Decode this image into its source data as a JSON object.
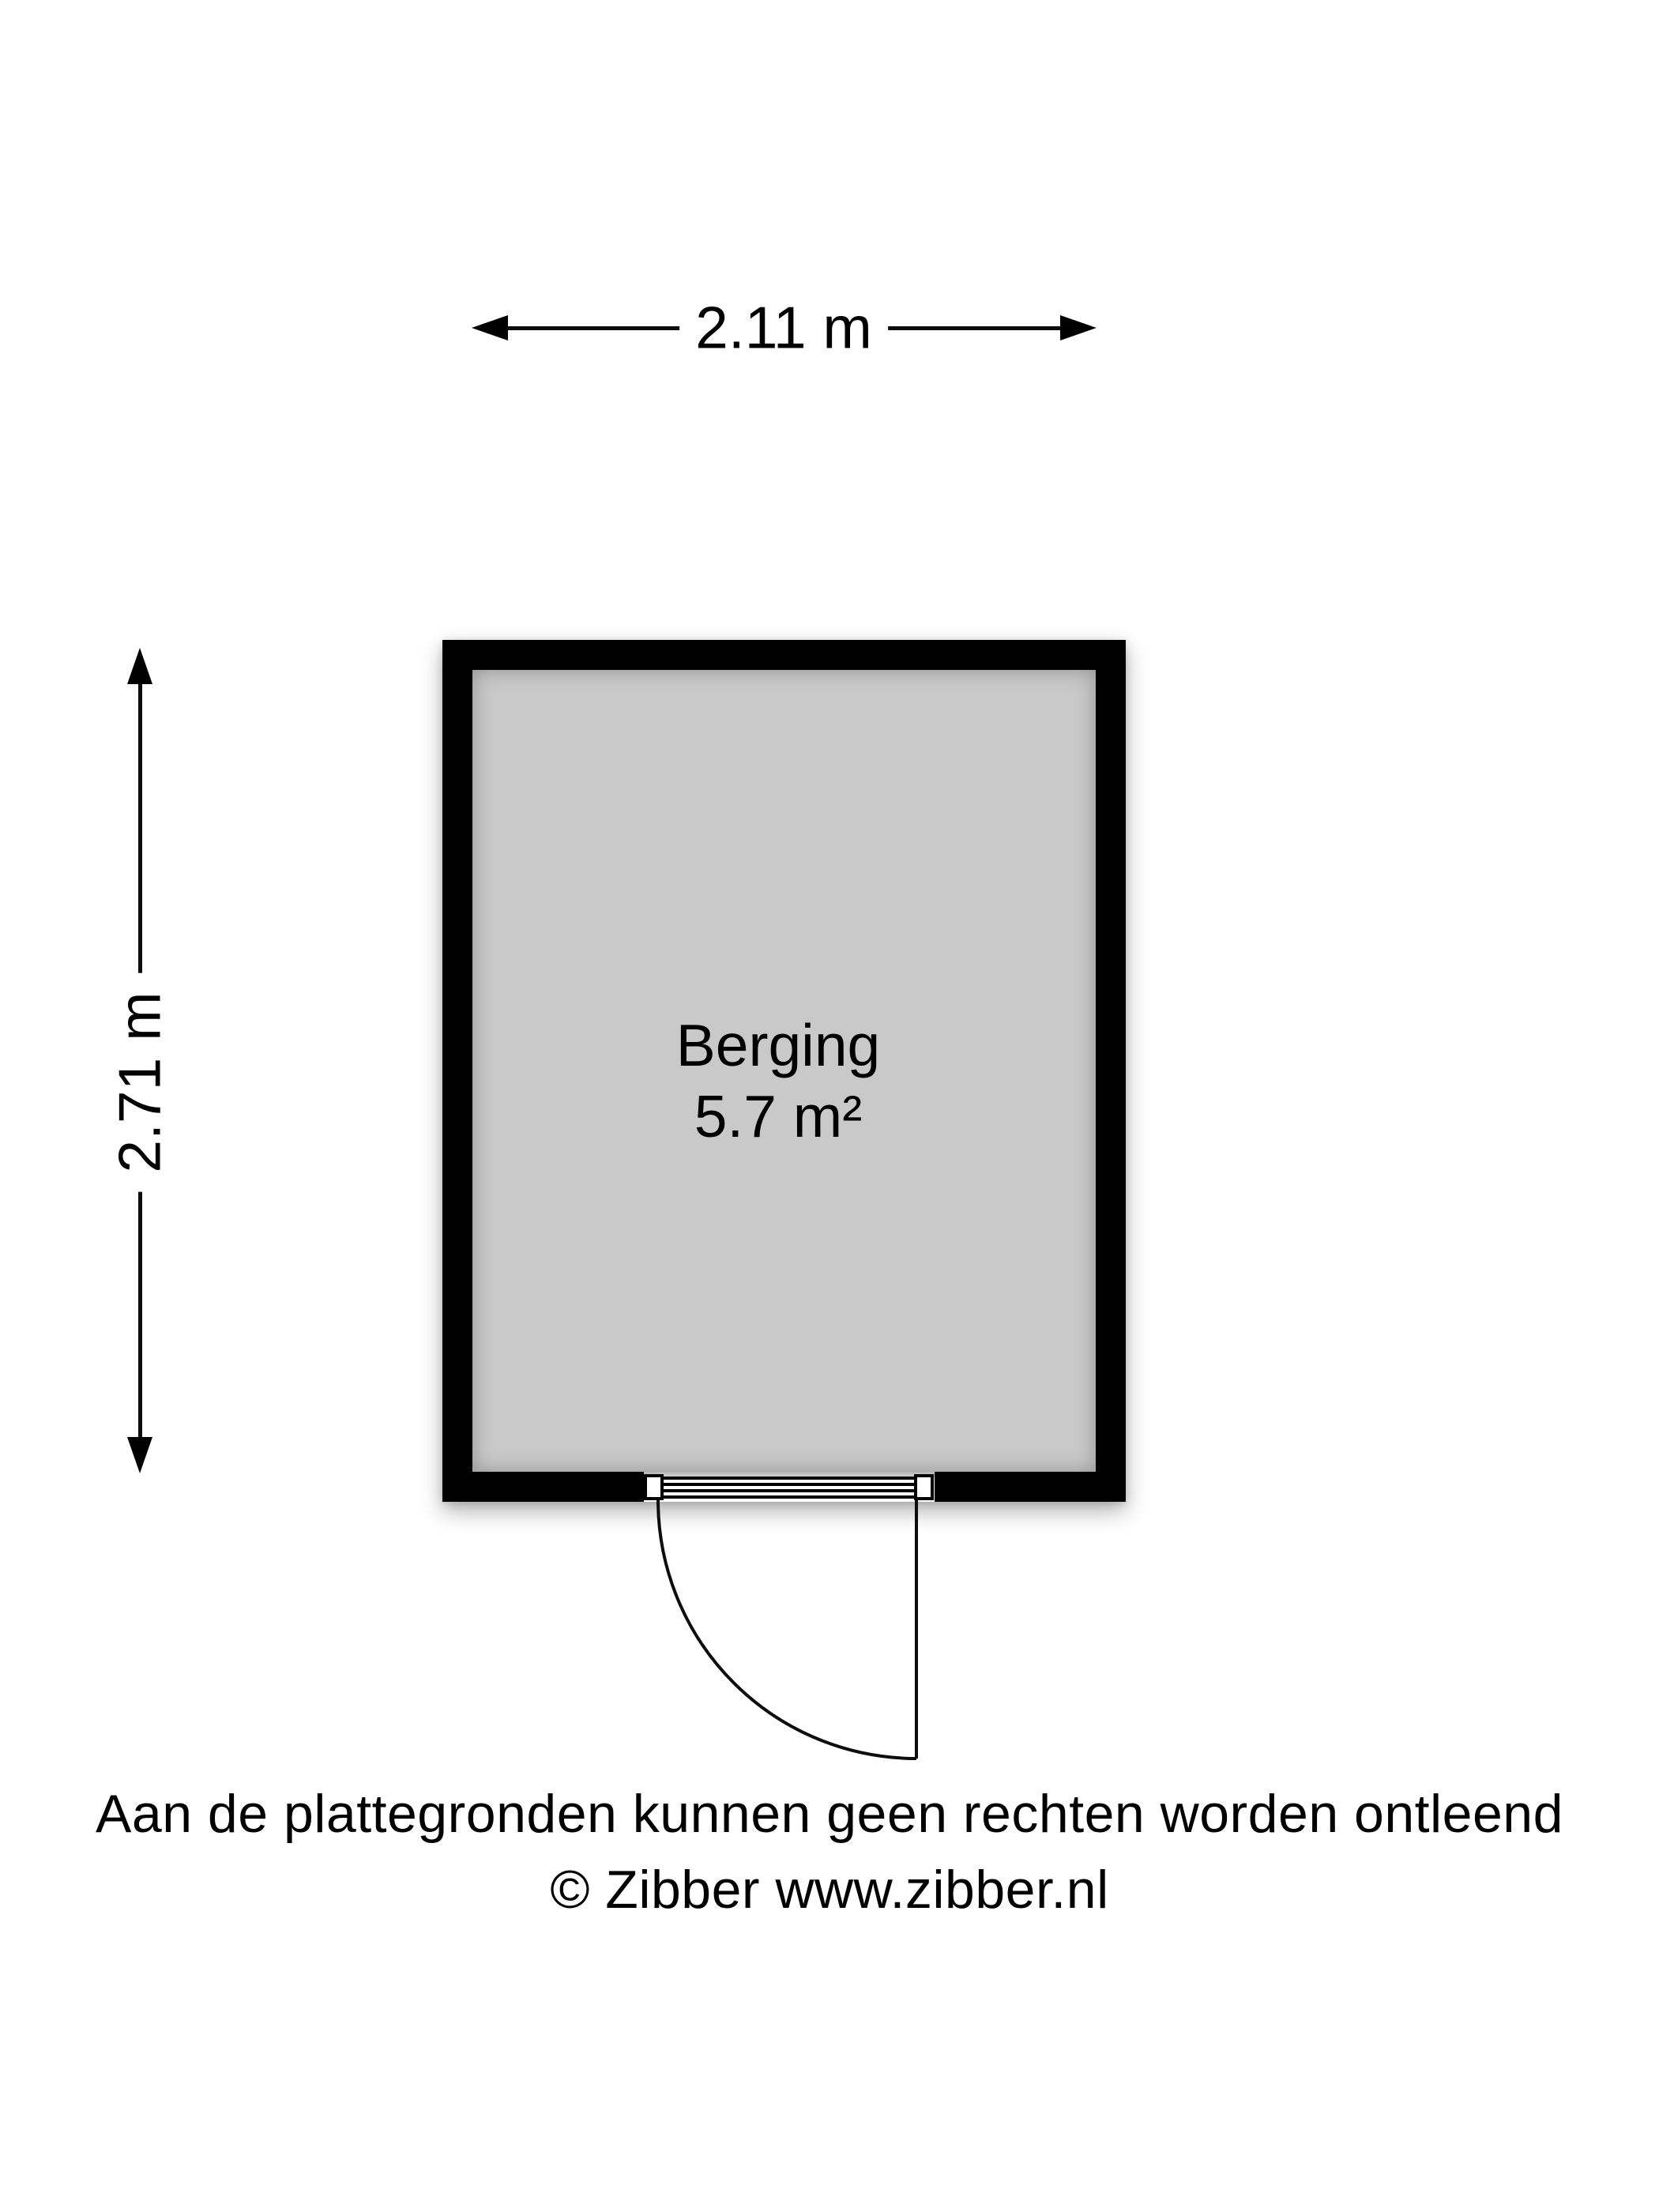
{
  "room": {
    "name": "Berging",
    "area": "5.7 m²"
  },
  "dimensions": {
    "width_label": "2.11 m",
    "height_label": "2.71 m"
  },
  "footer": {
    "disclaimer": "Aan de plattegronden kunnen geen rechten worden ontleend",
    "copyright": "© Zibber www.zibber.nl"
  },
  "colors": {
    "wall": "#000000",
    "floor": "#c9c9c9",
    "background": "#ffffff",
    "line": "#0d0d0d"
  }
}
